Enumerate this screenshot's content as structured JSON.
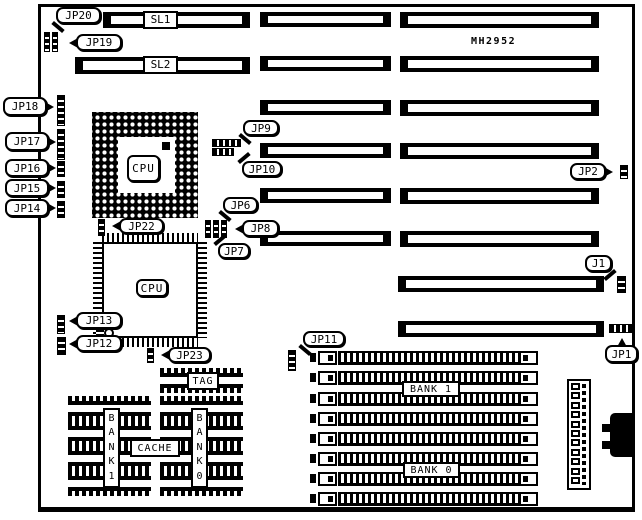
{
  "title": "MH2952",
  "colors": {
    "ink": "#000000",
    "paper": "#ffffff"
  },
  "board": {
    "x": 38,
    "y": 4,
    "w": 597,
    "h": 508
  },
  "slots": [
    {
      "id": "sl1",
      "x": 103,
      "y": 12,
      "w": 147,
      "h": 16,
      "label": "SL1",
      "ldx": 40
    },
    {
      "id": "sl2",
      "x": 75,
      "y": 57,
      "w": 175,
      "h": 17,
      "label": "SL2",
      "ldx": 68
    },
    {
      "id": "mid-1",
      "x": 260,
      "y": 12,
      "w": 131,
      "h": 15
    },
    {
      "id": "mid-2",
      "x": 260,
      "y": 56,
      "w": 131,
      "h": 15
    },
    {
      "id": "mid-3",
      "x": 260,
      "y": 100,
      "w": 131,
      "h": 15
    },
    {
      "id": "mid-4",
      "x": 260,
      "y": 143,
      "w": 131,
      "h": 15
    },
    {
      "id": "mid-5",
      "x": 260,
      "y": 188,
      "w": 131,
      "h": 15
    },
    {
      "id": "mid-6",
      "x": 260,
      "y": 231,
      "w": 131,
      "h": 15
    },
    {
      "id": "right-1",
      "x": 400,
      "y": 12,
      "w": 199,
      "h": 16
    },
    {
      "id": "right-2",
      "x": 400,
      "y": 56,
      "w": 199,
      "h": 16
    },
    {
      "id": "right-3",
      "x": 400,
      "y": 100,
      "w": 199,
      "h": 16
    },
    {
      "id": "right-4",
      "x": 400,
      "y": 143,
      "w": 199,
      "h": 16
    },
    {
      "id": "right-5",
      "x": 400,
      "y": 188,
      "w": 199,
      "h": 16
    },
    {
      "id": "right-6",
      "x": 400,
      "y": 231,
      "w": 199,
      "h": 16
    },
    {
      "id": "right-7",
      "x": 398,
      "y": 276,
      "w": 206,
      "h": 16
    },
    {
      "id": "right-8",
      "x": 398,
      "y": 321,
      "w": 206,
      "h": 16
    }
  ],
  "callouts": [
    {
      "label": "JP20",
      "x": 56,
      "y": 7,
      "w": 45,
      "h": 17,
      "tail": "bl"
    },
    {
      "label": "JP19",
      "x": 76,
      "y": 34,
      "w": 46,
      "h": 17,
      "tail": "left"
    },
    {
      "label": "JP18",
      "x": 3,
      "y": 97,
      "w": 44,
      "h": 19,
      "tail": "right"
    },
    {
      "label": "JP17",
      "x": 5,
      "y": 132,
      "w": 44,
      "h": 19,
      "tail": "right"
    },
    {
      "label": "JP16",
      "x": 5,
      "y": 159,
      "w": 44,
      "h": 18,
      "tail": "right"
    },
    {
      "label": "JP15",
      "x": 5,
      "y": 179,
      "w": 44,
      "h": 18,
      "tail": "right"
    },
    {
      "label": "JP14",
      "x": 5,
      "y": 199,
      "w": 44,
      "h": 18,
      "tail": "right"
    },
    {
      "label": "JP9",
      "x": 243,
      "y": 120,
      "w": 36,
      "h": 16,
      "tail": "bl"
    },
    {
      "label": "JP10",
      "x": 242,
      "y": 161,
      "w": 40,
      "h": 16,
      "tail": "tl"
    },
    {
      "label": "JP2",
      "x": 570,
      "y": 163,
      "w": 36,
      "h": 17,
      "tail": "right"
    },
    {
      "label": "J1",
      "x": 585,
      "y": 255,
      "w": 27,
      "h": 17,
      "tail": "br"
    },
    {
      "label": "JP6",
      "x": 223,
      "y": 197,
      "w": 35,
      "h": 16,
      "tail": "bl"
    },
    {
      "label": "JP8",
      "x": 242,
      "y": 220,
      "w": 37,
      "h": 17,
      "tail": "left"
    },
    {
      "label": "JP7",
      "x": 218,
      "y": 243,
      "w": 32,
      "h": 16,
      "tail": "tl"
    },
    {
      "label": "JP22",
      "x": 119,
      "y": 218,
      "w": 45,
      "h": 16,
      "tail": "left"
    },
    {
      "label": "JP13",
      "x": 76,
      "y": 312,
      "w": 46,
      "h": 17,
      "tail": "left"
    },
    {
      "label": "JP12",
      "x": 76,
      "y": 335,
      "w": 46,
      "h": 17,
      "tail": "left"
    },
    {
      "label": "JP23",
      "x": 168,
      "y": 347,
      "w": 43,
      "h": 16,
      "tail": "left"
    },
    {
      "label": "JP11",
      "x": 303,
      "y": 331,
      "w": 42,
      "h": 16,
      "tail": "bl"
    },
    {
      "label": "JP1",
      "x": 605,
      "y": 345,
      "w": 33,
      "h": 18,
      "tail": "top"
    }
  ],
  "jumper_blocks": [
    {
      "id": "jp19-20-a",
      "x": 44,
      "y": 32,
      "w": 6,
      "h": 20,
      "dir": "v"
    },
    {
      "id": "jp19-20-b",
      "x": 52,
      "y": 32,
      "w": 6,
      "h": 20,
      "dir": "v"
    },
    {
      "id": "jp18",
      "x": 57,
      "y": 95,
      "w": 8,
      "h": 31,
      "dir": "v"
    },
    {
      "id": "jp17",
      "x": 57,
      "y": 129,
      "w": 8,
      "h": 31,
      "dir": "v"
    },
    {
      "id": "jp16",
      "x": 57,
      "y": 161,
      "w": 8,
      "h": 16,
      "dir": "v"
    },
    {
      "id": "jp15",
      "x": 57,
      "y": 181,
      "w": 8,
      "h": 17,
      "dir": "v"
    },
    {
      "id": "jp14",
      "x": 57,
      "y": 201,
      "w": 8,
      "h": 17,
      "dir": "v"
    },
    {
      "id": "jp9",
      "x": 212,
      "y": 139,
      "w": 29,
      "h": 8,
      "dir": "h"
    },
    {
      "id": "jp10",
      "x": 212,
      "y": 148,
      "w": 22,
      "h": 8,
      "dir": "h"
    },
    {
      "id": "jp2",
      "x": 620,
      "y": 165,
      "w": 8,
      "h": 14,
      "dir": "v"
    },
    {
      "id": "j1",
      "x": 617,
      "y": 276,
      "w": 9,
      "h": 17,
      "dir": "v"
    },
    {
      "id": "jp678-a",
      "x": 205,
      "y": 220,
      "w": 6,
      "h": 18,
      "dir": "v"
    },
    {
      "id": "jp678-b",
      "x": 213,
      "y": 220,
      "w": 6,
      "h": 18,
      "dir": "v"
    },
    {
      "id": "jp678-c",
      "x": 221,
      "y": 220,
      "w": 6,
      "h": 18,
      "dir": "v"
    },
    {
      "id": "jp22",
      "x": 98,
      "y": 219,
      "w": 7,
      "h": 17,
      "dir": "v"
    },
    {
      "id": "jp13",
      "x": 57,
      "y": 315,
      "w": 8,
      "h": 19,
      "dir": "v"
    },
    {
      "id": "jp12",
      "x": 57,
      "y": 337,
      "w": 9,
      "h": 18,
      "dir": "v"
    },
    {
      "id": "jp23",
      "x": 147,
      "y": 348,
      "w": 7,
      "h": 15,
      "dir": "v"
    },
    {
      "id": "jp11",
      "x": 288,
      "y": 350,
      "w": 8,
      "h": 21,
      "dir": "v"
    },
    {
      "id": "jp1",
      "x": 609,
      "y": 324,
      "w": 24,
      "h": 9,
      "dir": "h"
    }
  ],
  "pga": {
    "label": "CPU",
    "x": 92,
    "y": 112,
    "w": 106,
    "h": 106,
    "inner": {
      "x": 118,
      "y": 137,
      "w": 57,
      "h": 56
    },
    "dot": {
      "x": 162,
      "y": 142,
      "w": 8,
      "h": 8
    },
    "box": {
      "x": 127,
      "y": 155,
      "w": 33,
      "h": 27
    }
  },
  "qfp": {
    "label": "CPU",
    "x": 102,
    "y": 242,
    "w": 96,
    "h": 96,
    "pin": 9,
    "box": {
      "x": 136,
      "y": 279,
      "w": 32,
      "h": 18
    }
  },
  "dips": [
    {
      "id": "tag",
      "x": 160,
      "y": 368,
      "w": 83,
      "h": 25
    },
    {
      "id": "cache-l1",
      "x": 68,
      "y": 396,
      "w": 83,
      "h": 25
    },
    {
      "id": "cache-l2",
      "x": 68,
      "y": 421,
      "w": 83,
      "h": 25
    },
    {
      "id": "cache-l3",
      "x": 68,
      "y": 446,
      "w": 83,
      "h": 25
    },
    {
      "id": "cache-l4",
      "x": 68,
      "y": 471,
      "w": 83,
      "h": 25
    },
    {
      "id": "cache-r1",
      "x": 160,
      "y": 396,
      "w": 83,
      "h": 25
    },
    {
      "id": "cache-r2",
      "x": 160,
      "y": 421,
      "w": 83,
      "h": 25
    },
    {
      "id": "cache-r3",
      "x": 160,
      "y": 446,
      "w": 83,
      "h": 25
    },
    {
      "id": "cache-r4",
      "x": 160,
      "y": 471,
      "w": 83,
      "h": 25
    }
  ],
  "chip_labels": [
    {
      "id": "tag",
      "label": "TAG",
      "x": 187,
      "y": 372,
      "w": 32,
      "h": 18,
      "vertical": false
    },
    {
      "id": "cache",
      "label": "CACHE",
      "x": 130,
      "y": 439,
      "w": 50,
      "h": 18,
      "vertical": false
    },
    {
      "id": "dip-bank1",
      "label": "BANK 1",
      "x": 103,
      "y": 408,
      "w": 17,
      "h": 80,
      "vertical": true
    },
    {
      "id": "dip-bank0",
      "label": "BANK 0",
      "x": 191,
      "y": 408,
      "w": 17,
      "h": 80,
      "vertical": true
    },
    {
      "id": "simm-bank1",
      "label": "BANK 1",
      "x": 402,
      "y": 381,
      "w": 58,
      "h": 16,
      "vertical": false
    },
    {
      "id": "simm-bank0",
      "label": "BANK 0",
      "x": 403,
      "y": 462,
      "w": 57,
      "h": 16,
      "vertical": false
    }
  ],
  "simms": {
    "x": 310,
    "w": 228,
    "h": 14,
    "rows": [
      351,
      371,
      392,
      412,
      432,
      452,
      472,
      492
    ]
  },
  "power_connector": {
    "x": 567,
    "y": 379,
    "w": 24,
    "h": 111,
    "pins": 11
  },
  "keyboard_connector": {
    "main": {
      "x": 610,
      "y": 413,
      "w": 23,
      "h": 44
    },
    "tabs": [
      {
        "x": 602,
        "y": 424,
        "w": 9,
        "h": 8
      },
      {
        "x": 602,
        "y": 441,
        "w": 9,
        "h": 8
      }
    ]
  },
  "misc_component": {
    "bars": {
      "x": 96,
      "y": 329,
      "w": 8,
      "h": 9
    },
    "circle": {
      "x": 104,
      "y": 328,
      "w": 10,
      "h": 10
    }
  }
}
